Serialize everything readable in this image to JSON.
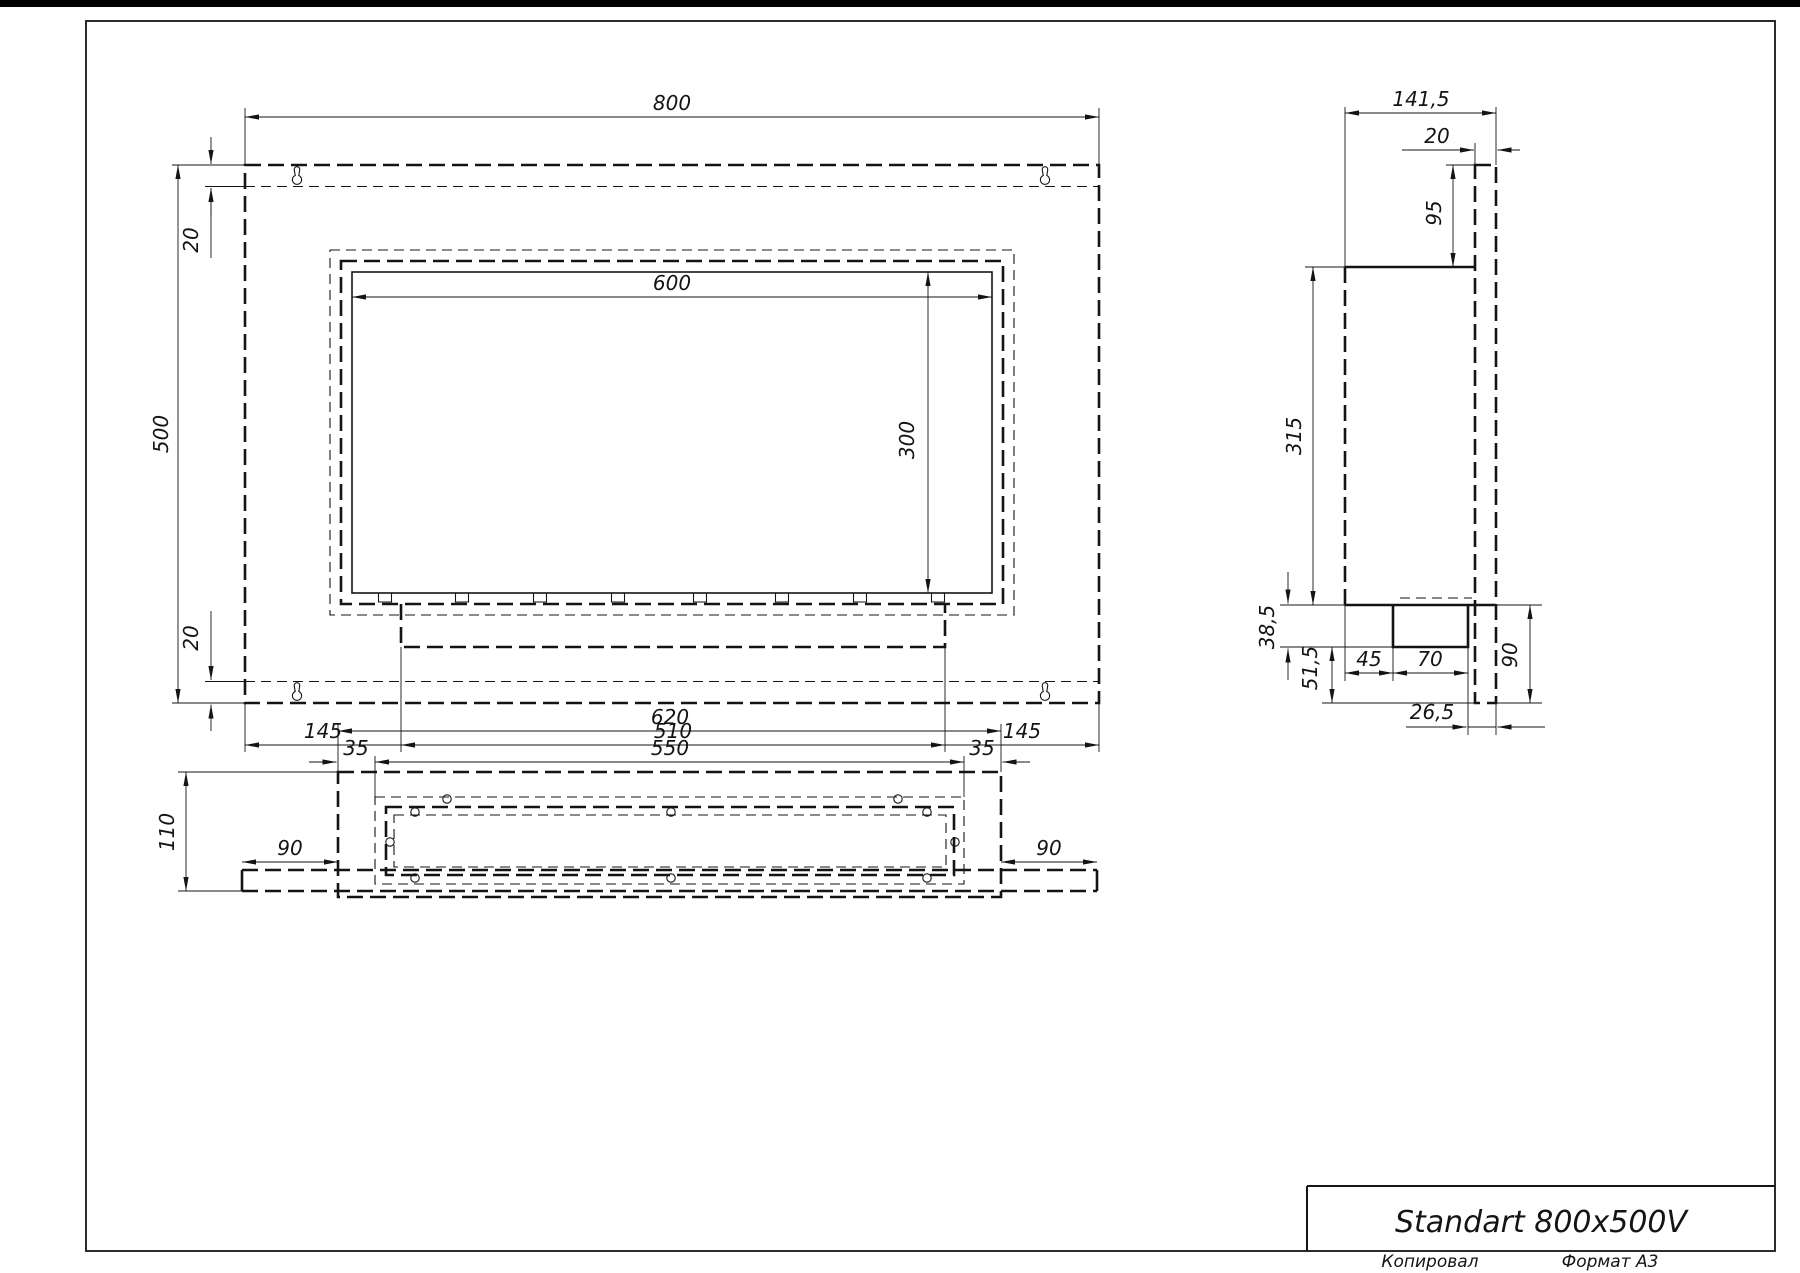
{
  "title_block": {
    "title": "Standart 800x500V",
    "copied": "Копировал",
    "format": "Формат А3"
  },
  "front_view": {
    "dim_width": "800",
    "dim_height": "500",
    "dim_offset_top": "20",
    "dim_offset_bottom": "20",
    "dim_opening_width": "600",
    "dim_opening_height": "300",
    "dim_margin_left": "145",
    "dim_burner_width": "510",
    "dim_margin_right": "145"
  },
  "side_view": {
    "dim_depth": "141,5",
    "dim_panel_thickness": "20",
    "dim_top_offset": "95",
    "dim_box_height": "315",
    "dim_bench_height": "38,5",
    "dim_bottom_offset": "51,5",
    "dim_bench_setback": "45",
    "dim_bench_depth": "70",
    "dim_back_gap": "26,5",
    "dim_panel_below_box": "90"
  },
  "bottom_view": {
    "dim_box_width": "620",
    "dim_inner_width": "550",
    "dim_side_offset_left": "35",
    "dim_side_offset_right": "35",
    "dim_depth": "110",
    "dim_wing_left": "90",
    "dim_wing_right": "90"
  }
}
